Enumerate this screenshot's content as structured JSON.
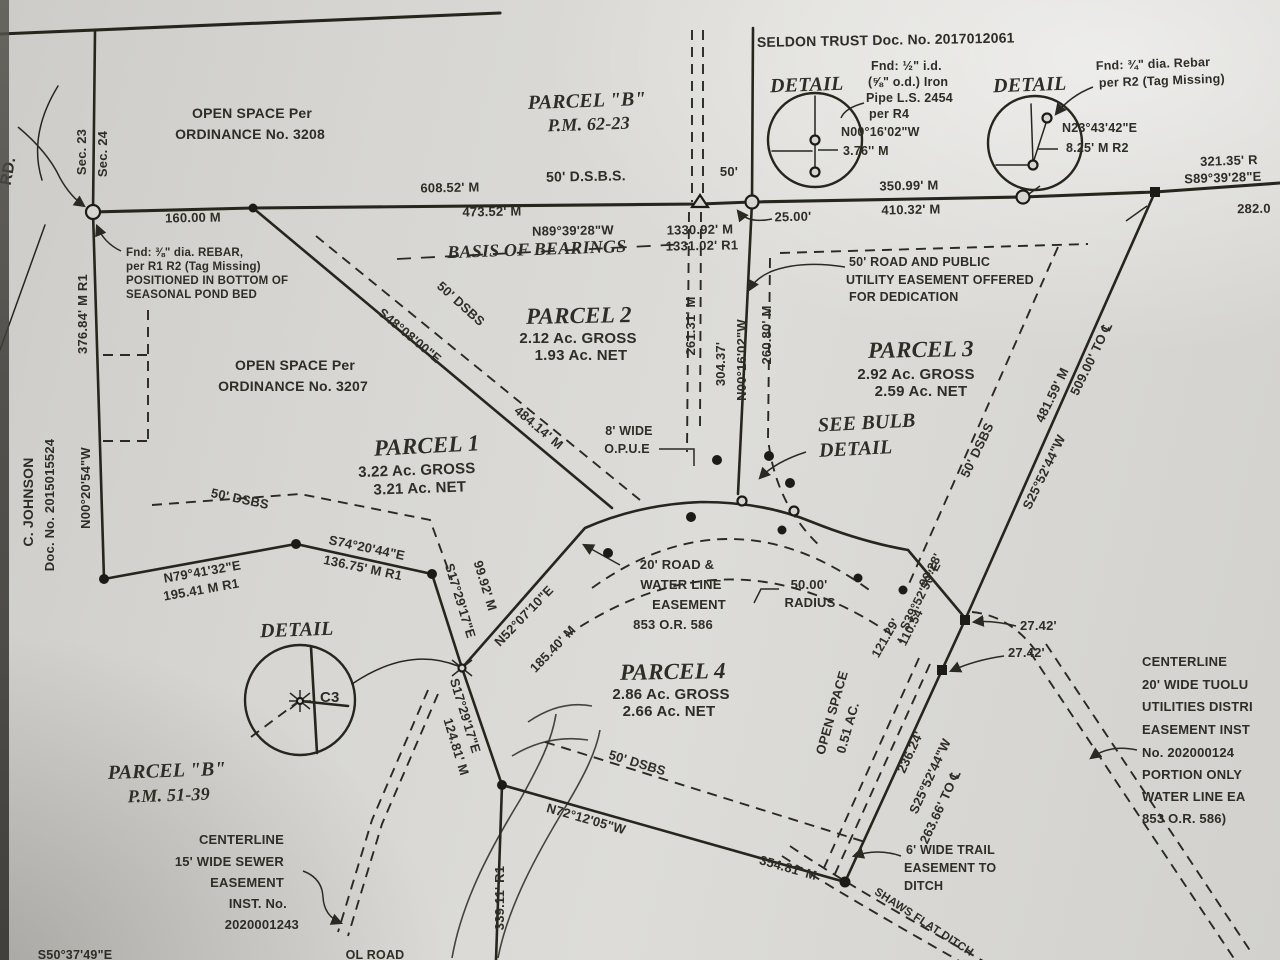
{
  "colors": {
    "ink": "#2b2a23",
    "paper": "#d7d6d2"
  },
  "top_left": {
    "open_space_1": "OPEN SPACE Per",
    "open_space_2": "ORDINANCE No. 3208",
    "sec23": "Sec. 23",
    "sec24": "Sec. 24",
    "road": "RD.",
    "dist_160": "160.00 M",
    "rebar_1": "Fnd: ⅜\" dia. REBAR,",
    "rebar_2": "per R1 R2 (Tag Missing)",
    "rebar_3": "POSITIONED IN BOTTOM OF",
    "rebar_4": "SEASONAL POND BED",
    "owner_1": "C. JOHNSON",
    "owner_2": "Doc. No. 2015015524",
    "west_brg": "N00°20'54\"W",
    "west_dist": "376.84' M R1",
    "os3207_1": "OPEN SPACE Per",
    "os3207_2": "ORDINANCE No. 3207",
    "dsbs": "50' DSBS",
    "n79_brg": "N79°41'32\"E",
    "n79_dist": "195.41 M R1"
  },
  "top_center": {
    "parcel_b": "PARCEL \"B\"",
    "pm": "P.M. 62-23",
    "dsbs": "50' D.S.B.S.",
    "d608": "608.52' M",
    "d473": "473.52' M",
    "brg": "N89°39'28\"W",
    "dist_m": "1330.92' M",
    "dist_r": "1331.02' R1",
    "basis": "BASIS OF BEARINGS",
    "d50": "50'",
    "d25": "25.00'"
  },
  "top_right": {
    "seldon": "SELDON TRUST Doc. No. 2017012061",
    "detail1": "DETAIL",
    "d1_note1": "Fnd: ½\" i.d.",
    "d1_note2": "(⅝\" o.d.) Iron",
    "d1_note3": "Pipe L.S. 2454",
    "d1_note4": "per R4",
    "d1_brg": "N00°16'02\"W",
    "d1_dist": "3.76'' M",
    "detail2": "DETAIL",
    "d2_note1": "Fnd: ¾\" dia. Rebar",
    "d2_note2": "per R2 (Tag Missing)",
    "d2_brg": "N23°43'42\"E",
    "d2_dist": "8.25' M R2",
    "d350": "350.99' M",
    "d410": "410.32' M",
    "d321": "321.35' R",
    "s89": "S89°39'28\"E",
    "d282": "282.0"
  },
  "center": {
    "v261": "261.31' M",
    "v304": "304.37'",
    "vbrg": "N00°16'02\"W",
    "v260": "260.80' M",
    "s48_brg": "S48°08'00\"E",
    "s48_dist": "484.14' M",
    "dsbs_p2": "50' DSBS",
    "opue_1": "8' WIDE",
    "opue_2": "O.P.U.E",
    "road20_1": "20' ROAD &",
    "road20_2": "WATER LINE",
    "road20_3": "EASEMENT",
    "road20_4": "853 O.R. 586",
    "radius_1": "50.00'",
    "radius_2": "RADIUS",
    "s17a_brg": "S17°29'17\"E",
    "s17a_dist": "99.92' M",
    "n52_brg": "N52°07'10\"E",
    "n52_dist": "185.40' M",
    "s74_brg": "S74°20'44\"E",
    "s74_dist": "136.75' M R1",
    "see_bulb_1": "SEE BULB",
    "see_bulb_2": "DETAIL",
    "d9928": "99.28'",
    "s39": "S39°52'50\"E",
    "d11054": "110.54'",
    "d12129": "121.29'",
    "d2742a": "27.42'",
    "d2742b": "27.42'"
  },
  "parcels": [
    {
      "name": "PARCEL 1",
      "gross": "3.22 Ac. GROSS",
      "net": "3.21 Ac. NET"
    },
    {
      "name": "PARCEL 2",
      "gross": "2.12 Ac. GROSS",
      "net": "1.93 Ac. NET"
    },
    {
      "name": "PARCEL 3",
      "gross": "2.92 Ac. GROSS",
      "net": "2.59 Ac. NET"
    },
    {
      "name": "PARCEL 4",
      "gross": "2.86 Ac. GROSS",
      "net": "2.66 Ac. NET"
    }
  ],
  "east": {
    "dedication_1": "50' ROAD AND PUBLIC",
    "dedication_2": "UTILITY EASEMENT OFFERED",
    "dedication_3": "FOR DEDICATION",
    "dsbs": "50' DSBS",
    "d481": "481.59' M",
    "d509": "509.00' TO ℄",
    "s25": "S25°52'44\"W"
  },
  "south": {
    "open_space_1": "OPEN SPACE",
    "open_space_2": "0.51 AC.",
    "d236": "236.24'",
    "s25": "S25°52'44\"W",
    "d263": "263.66' TO ℄",
    "dsbs": "50' DSBS",
    "n72_brg": "N72°12'05\"W",
    "n72_dist": "354.81' M",
    "v339": "339.11' R1",
    "s17b_brg": "S17°29'17\"E",
    "s17b_dist": "124.81' M",
    "trail_1": "6' WIDE TRAIL",
    "trail_2": "EASEMENT TO",
    "trail_3": "DITCH",
    "ditch": "SHAWS FLAT DITCH",
    "frag_road": "OL ROAD",
    "frag_brg": "S50°37'49\"E"
  },
  "bottom_left": {
    "detail3": "DETAIL",
    "c3": "C3",
    "parcel_b": "PARCEL \"B\"",
    "pm": "P.M. 51-39",
    "sewer_1": "CENTERLINE",
    "sewer_2": "15' WIDE SEWER",
    "sewer_3": "EASEMENT",
    "sewer_4": "INST. No.",
    "sewer_5": "2020001243"
  },
  "right_note": {
    "l1": "CENTERLINE",
    "l2": "20' WIDE TUOLU",
    "l3": "UTILITIES DISTRI",
    "l4": "EASEMENT INST",
    "l5": "No. 202000124",
    "l6": "PORTION ONLY",
    "l7": "WATER LINE EA",
    "l8": "853 O.R. 586)"
  }
}
